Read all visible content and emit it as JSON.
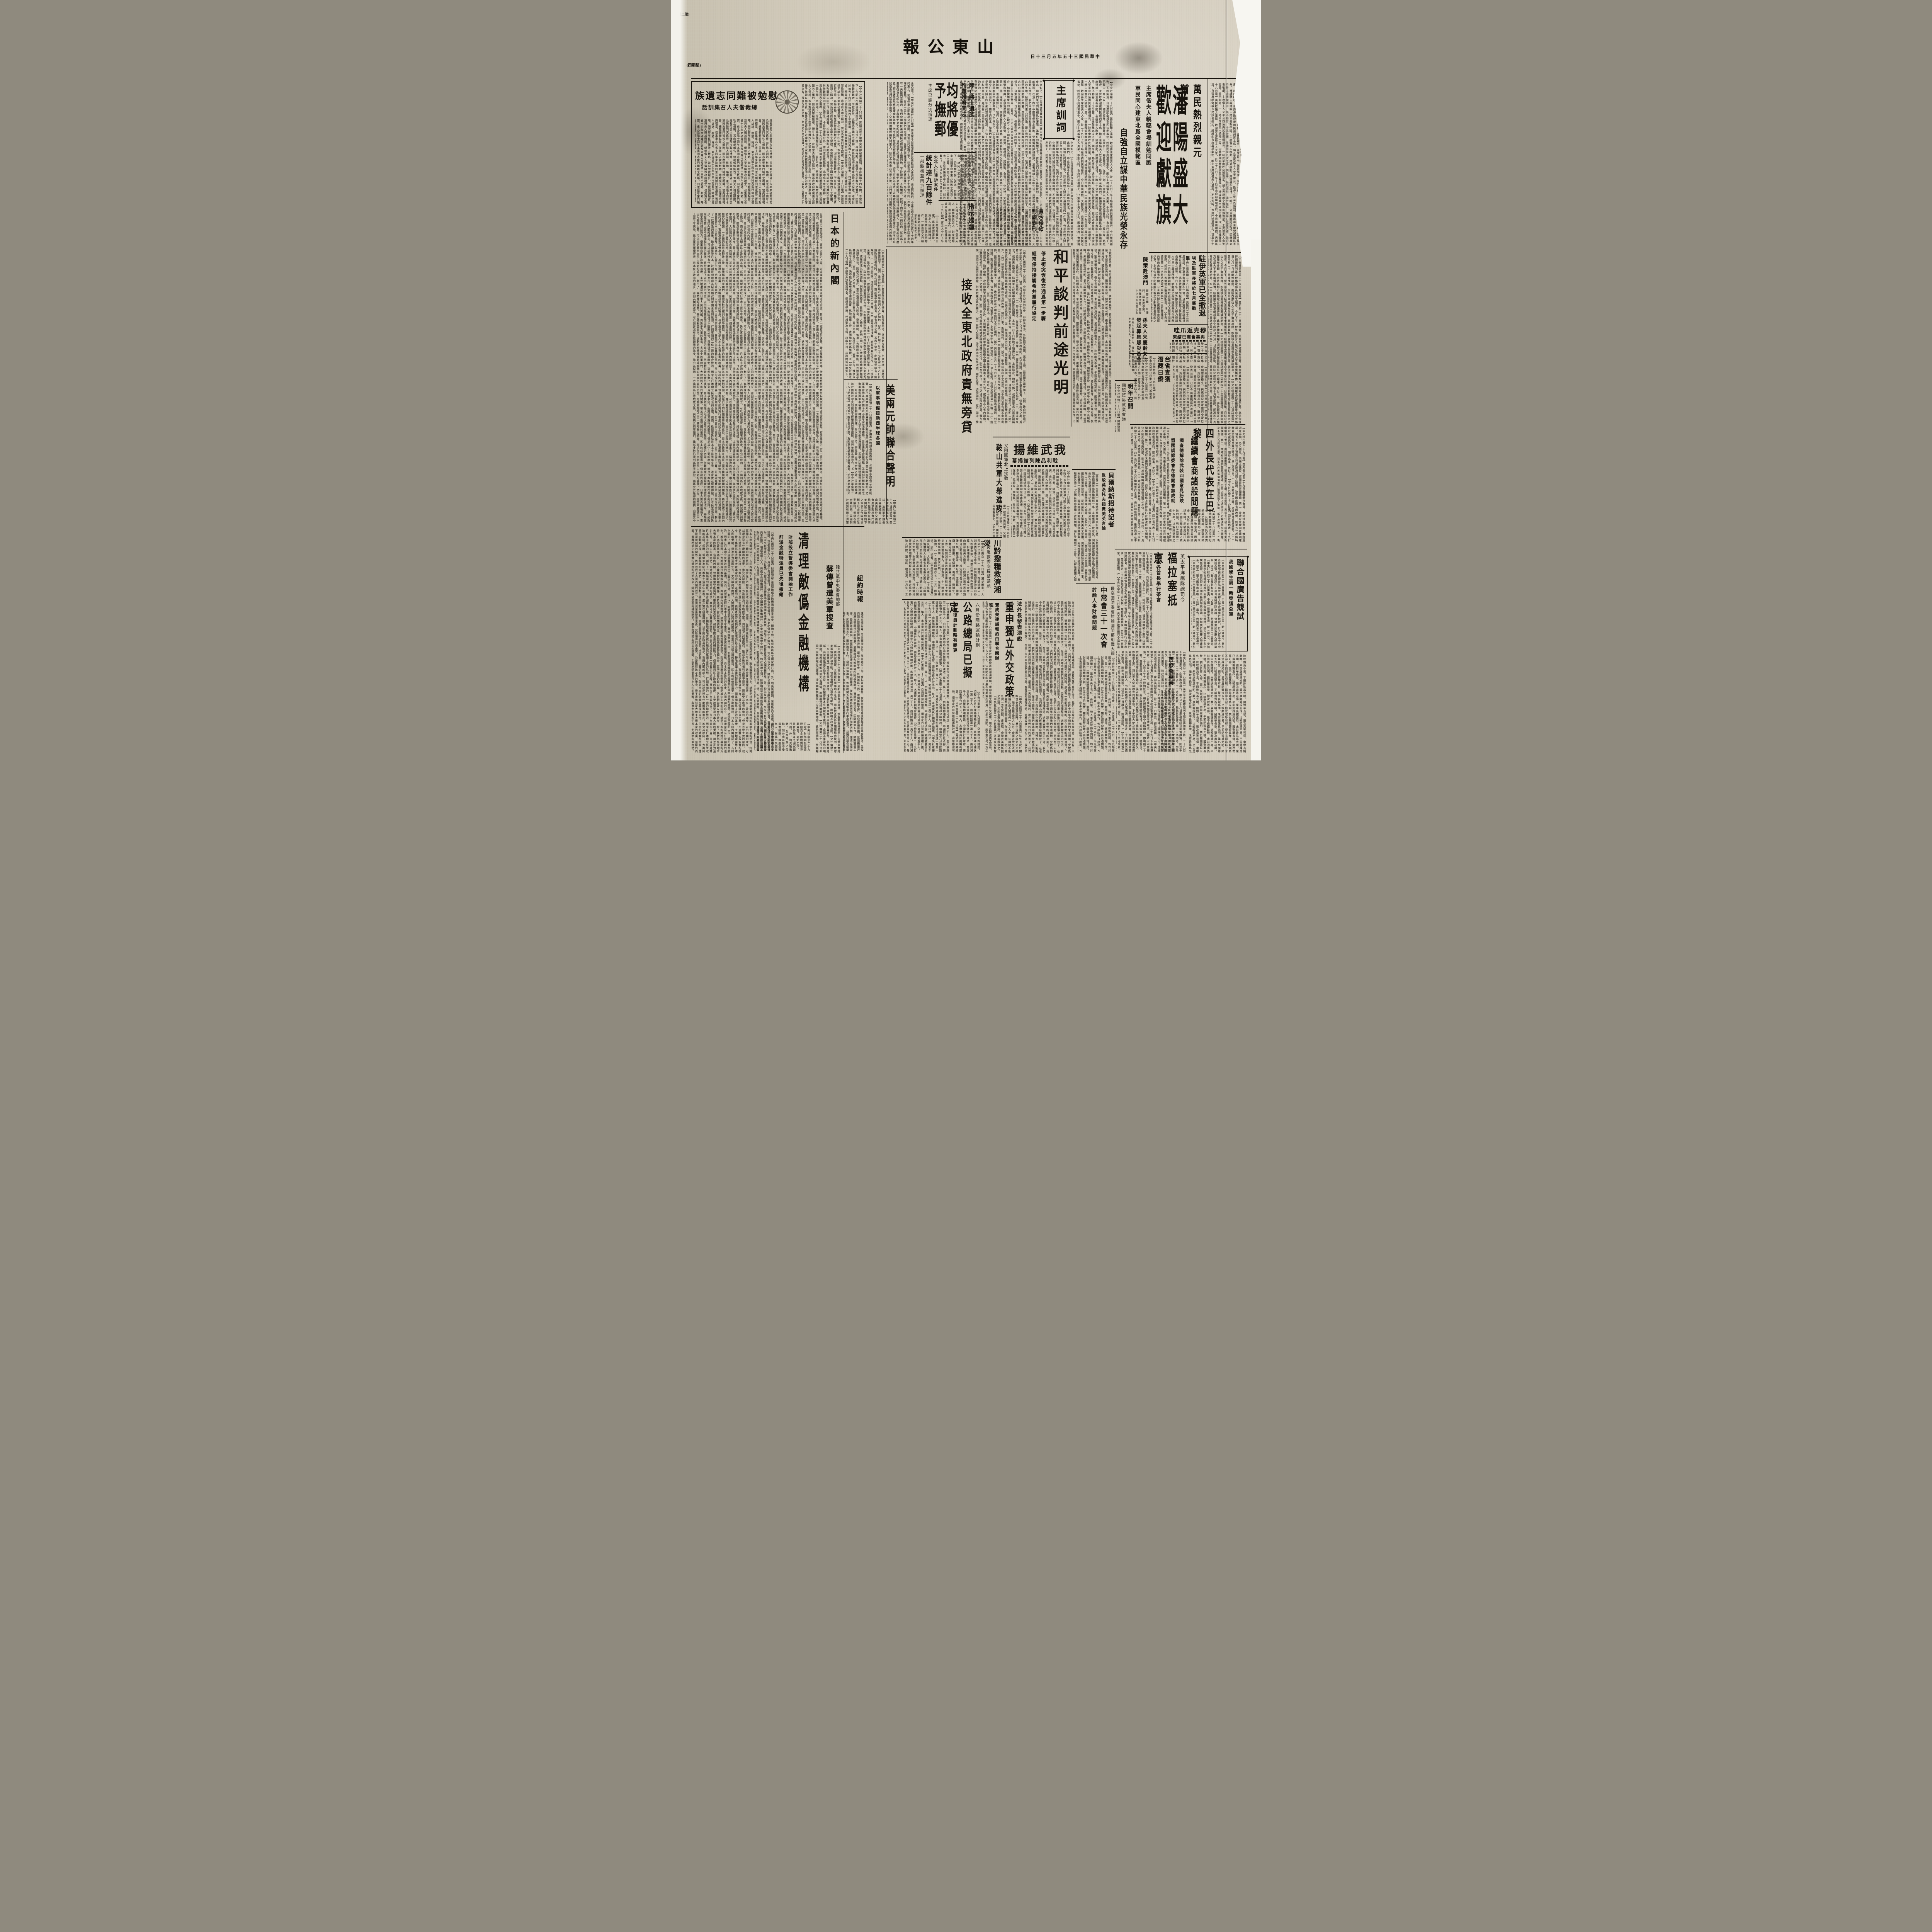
{
  "paper_color": "#cfc8b7",
  "ink_color": "#17130d",
  "icons": {
    "diamond": "◆"
  },
  "header": {
    "page_note": "(第二頁)",
    "weekday": "(星期四)",
    "masthead": "山東公報",
    "dateline": "中華民國三十五年五月三十日"
  },
  "articles": {
    "shenyang": {
      "kicker": "萬民熱烈親元首",
      "title": "瀋陽盛大歡迎獻旗",
      "sub1": "主席偕夫人親臨會場訓勉同胞",
      "sub2": "軍民同心建東北爲全國模範區",
      "bold": "自強自立謀中華民族光榮永存",
      "body": "【中央社瀋陽二十九日電】萬民歡騰之瀋陽、歡迎蔣主席暨夫人大會、於二十九日上午十時在市府前廣場舉行、今日薰風和煦、天朗氣清、自清晨起全城市民扶老攜幼、紛紛向市府廣場集中、瞻仰主席威儀夫人風采、不到九時、市府門前廣場上、已集中十萬人以上、國旗招展、會樂聲喧、主席台上、佈置簡潔、九時三刻、主席偕夫人乘車蒞臨會場、三十萬民衆、熱烈歡呼、並齊呼歡迎復興民族的蔣主席、時正主席偕夫人登主席台、歡呼之聲益爲熱烈、擁護蔣主席完成國民革命、擁護蔣主席建設三民主義新中國、主席暨夫人臨此、民衆感動、頻頻舉手爲禮、十時二十分主席開始訓話、民衆肅立恭聆主席懇摯訓示、無不動容、十五分鐘、民衆鼓掌九次之多、訓話畢、熱烈情形、達於極點、旋舉行獻旗典禮、歡迎大會敬獻、主席偕夫人至平台四角與民衆揚帽相見、一時民衆歡呼民族救星、婦女界所獻之旗爲民族救星、主席暨夫人含笑接受、並示謝意、十一時主席暨夫人繞場一周、中華救國協會獻旗爲世界偉人、禮成後乘車返回行轅、W"
    },
    "xunci": {
      "box_title": "主席訓詞",
      "body": "全文如下、【中央社瀋陽廿九日電】蔣主席今日在瀋各界民衆歡迎大會訓詞、東北同胞們、中正夫婦今日來到淪陷了十四年的東北、和我們東北同胞相見於瀋陽、滿地紅的旗幟之下、這是我們夫婦平生最愉快的一件事、也是我們夫婦十四年來的理想的實現、在這十四年中間我們東北同胞、受敵僞的摧殘壓迫、過著奴隸牛馬的生活、我們中央政府和全國同胞、是沒有一天能夠忘懷的、我們中國國民黨和國民政府領導全國同胞、不辭艱苦、不惜犧牲、抗戰十四年唯一的目的、就是爲了要收復東北的失地、拯救我們東北的同胞、現在我們的目的達到了、我們東北同胞已經獲得自由解放了、我們對於這種歷史上的偉績固然應該慶幸和興奮、然而我們在歡欣鼓舞的時候、切不可忘記過去十四年被異族侵凌奴辱的痛苦、切不可忘記過去我們爲求自由獨立全國同胞犧牲損失的重大、所以今天東北光復之後、我們東北同胞對外要記取過去痛苦的敎訓、鑒傷覆轍、埋頭努力、自重自惜、自立自強、保衛我們自由的領土、促進我們自由的幸福、益使我們中華民族世世代代的子孫能夠自由獨立光榮的生存於世界、（歡呼）中正夫婦此次來到東北主要的目的、是慰問我們歷年來備受痛苦的東北同胞、同時並揭示地方政府、如何復興東北的途徑、（歡呼）今天和各位同胞見面的時候還有幾點簡單的意思、要貢獻給大家、我們今後要求得東北的繁榮和復興、必須我們同胞人人習勤勞、尙勤勞、明禮義、知廉恥、負責任、守紀律、大家在政府的領導之下、軍民一致、同心一德、埋頭苦幹、來建設我們的東北、如此我相信不久的將來、我們東北一定可以成爲全國的模範區、成爲三民主義的實驗地、也必須如此、我們才能安慰十四年來爲收復東北而犧牲的軍民先烈在天之靈、最後中正夫婦以最愉快的心情、謹祝東北同胞自由解放萬歲、V"
    },
    "weimian": {
      "title": "慰勉被難同志遺族",
      "sub": "總裁偕夫人召集訓話",
      "body": "【中央社瀋陽二十九日電】蔣總裁近手諭中央黨部秘書處稱、東北淪陷十四年間、本黨地下工作同志在敵僞摧殘壓迫之下、百折不撓、再接再勵、與敵僞作長期艱苦之奮鬥、因而殉難破難者、所在多有、此種忠勇義烈之精神、實爲我政府收復東北最大之保證、本黨對於過去十四年間殉難烈士之家屬、及殉難同志因工作而致殘廢者、均宜優予撫卹以勵忠貞、秘書處已遵諭訂定殉難同志家屬與被難殘廢同志登記辦法、今日於瀋陽公佈、諸同志冒險犯難、此功成不居之精神、實足爲本黨同志之楷模、",
      "body2": "總裁偕夫人至瀋陽市政府禮堂、召集東北各省十四年來破難同志及殉難同志遺族二百餘人訓話、慰勉、略謂、東北淪陷十四年本黨同志奮鬥犧牲之槪略、同志歷年奮鬥犧牲之槪略、當向總裁報告、總裁頻頻點首、並與夫人親加慰問、"
    },
    "junjiang": {
      "kicker1": "陣亡將士遺族",
      "kicker2": "殉難殘廢同志",
      "title": "均將優予撫郵",
      "sub": "主席已諭分別辦理",
      "body": "【中央社瀋陽廿九日電】蔣主席關懷抗戰陣亡將士遺族、爲同志備受敵僞之迫害、中央無時不在關懷、然當時限於環境、無法援救、諸同志於此種艱難之狀況下、仍能奮鬥努力邁進、廿餘年來我國革命軍東北殉難之先烈在天之靈、東北可成爲全國之模範也、各位愛護過去之精神、刻苦奮鬥、則以今後工作環境之順利、相信各位工作成績亦必更佳於過去、總之今後東北之復興、端賴本黨同志一心同德、協助政府埋頭苦幹、至殉難同志遺族前慰問、接述函件、允予分別從優撫卹云、V"
    },
    "zhishi": {
      "title": "指示婦運",
      "body": "【中央社瀋陽二十九日電】蔣夫人今日下午接見杜夫人、將夫人接見杜夫人、及長官夫人、趙參謀長夫人、對東北婦運、指示各項工作、並詢東北婦運近況甚詳、"
    },
    "tongji": {
      "kicker": "東北人民陳訴案件",
      "title": "統計達九百餘件",
      "sub": "一部將攜至南京辦理",
      "body": "【中央社瀋陽廿九日電】蔣主席蒞瀋後、東北人民紛紛陳訴、其案件統計達九百餘件、一部份已交行轅秘書處分別辦理、一部將攜至南京辦理、"
    },
    "tanwu": {
      "t1": "貪污侵佔",
      "t2": "判處徒刑",
      "body": "（中央社訊）貪污侵佔公款者、經法院判處徒刑、以肅官箴、"
    },
    "heping": {
      "title": "和平談判前途光明",
      "sub1": "停止衝突恢復交通爲第一步驟",
      "sub2": "經常保持接觸希共黨履行協定",
      "side": "接收全東北政府責無旁貸",
      "body": "【中央社南京二十九日電】中部宣外記者招待會、彭部長學沛、外部劉次長鍇、出席主持、茲將問答誌要如下、（問）政府對於最近和平談判之方針如何、（答）與日報五月二十七日及二十八日社論所指出者相同、判之討論、對於若干基本事實、似有忽視之處、爲若干協定、此類協定中有三點規定、（一）停止衝突、恢復交通爲第一步驟、（二）經常保持接觸、希共黨履行協定、（三）接收全東北、政府責無旁貸、綜國軍及統編中共部隊爲國軍、本年一月十日停戰令頒佈以來、上述協定、均經公佈、政府除要求共黨實踐諾言外、不影響國民政府軍隊爲恢復中國主權而進入東北九省、或在東北九省內調動、別無其他條件、目前和平之條件、是明（問）美方代表將時時處於極端爲難之地位、則美方代表少、第三如僅須兩方同意、發布新聞、如須三方面同意始能、則其數量必甚爲稀少、（問）目前之間題、決不因此而有所改變、關於此事、近情如何、（答）如次、惟余以爲和平之前途、決不能以盧布或美金而出賣、馬帥返華之時、述諸階段更爲樂觀、W"
    },
    "riben": {
      "title": "日本的新內閣",
      "body": "日本吉田內閣組成了、吉田內閣的上臺、可以說是替日本民主政治的前途、劃出了一幅黯澹的遠景。聯合國擊毀日本、計劃是想根除其窮兵黷武的軍國主義的思想、打倒軍閥的二位一體的聯合統治、而求在日本樹立民主政治的基礎。然而、從盟軍進駐日本本土這半年來看、進步實在緩慢得很、日本民主政治的進步、吉田內閣的成立、可以說是沒有什麼顯著的進步。推究其原因：一方面因爲日本戰敗之後、與我稱兵的軍閥們、雖然多數已被列爲戰爭罪犯、而將受其應得的懲罰；但是其中主要的原因、就是日本的財閥在幕後的支持、日本的政黨在本質上還不能擺脫財閥的關係、終於造成了吉田內閣的成立、吉田茂是舊官僚出身、其所領導的自由黨、乃是戰前政友會的後身、骨子裏依然是大地主大資本家的政黨、這樣的內閣、很難希望它能夠實行徹底的民主改革、掃除軍國主義的殘餘勢力、倒軍閥與民主政治的演變、主要地還要靠日本人民的覺醒、與進步力量的生長、尤其中的軍閥們、大財閥的人民向來的關係、甚至可以說其鐵的懲罰、民主的成份還需要一個長期的過程、"
    },
    "meiliang": {
      "title": "美兩元帥聯合聲明",
      "sub": "以軍事裝備援助西半球各國",
      "body": "【中央社華盛頓二十八日路透電】美海軍作戰部長尼米茲、及陸軍參謀長艾森豪威爾、於出席美衆院外交委員會要求對杜魯門總統所提關於在與南美國家互助條約下之軍事合作區域計劃予以必要之立法手續時、曾發表聯合聲明稱、美國刻計劃將有限之海軍艦隻與軍事裝備、轉讓予西半球其他美洲國家、美國之防禦體制得與美國經濟劃一、尼米茲稱、該計劃需要訓練、另次戰爭時、得收最大限度合作之效、艾帥則簡述該計劃將以球其他國家之陸軍與空軍體制、得與美國互相符合、W"
    },
    "niuyue": {
      "title": "紐約時報",
      "body": "還成立振災會、民間籌振五作、限開籌振工作、發起普遍募捐、敦請梅蘭芳馬連良等舉行平劇義演、並擬商請各娛樂場所附加救濟捐、"
    },
    "suchuan": {
      "kicker": "韓共黨中央委會總部",
      "title": "蘇傳曾遭美軍搜查",
      "body": "【央社倫敦二十八日合衆電】莫斯科電台頃廣播、搜査朝鮮共產黨中央委員會總部、此共黨總部、共黨報紙案卷均予收沒、而自搜査後各有關報紙未復刊、僉認美軍當局此項舉動、冒在使朝鮮共黨失去威信、而阻礙其政治活動、"
    },
    "qingli": {
      "title": "清理敵僞金融機構",
      "sub1": "財部設立督導委會開始工作",
      "sub2": "前派金融特派員已先後撤銷",
      "body": "【中央社南京二十九日電】財部頃設立清理敵僞金融機搆督導委員會、開始工作、監督各該區之國家銀行局、外、均先後撤銷、至原所負之任務、則分由各督導委員會接辦、理處長等九人、與僞中央儲備銀行、僞中國聯合準備銀行、及東北僞滿中央銀行等、均在清理之列、財部頃設立清理敵僞金融機搆監督、督導各該區之國家銀行局、"
    },
    "wuwu": {
      "title": "我武維揚",
      "sub": "戰利品陳列館揭幕",
      "body": "【中央社南京二十九日電】中國陸軍總部今日上午十時在五台山隆重舉行陣亡將士殉難同胞神位奉移典禮、何總司令應欽、主持奉移典禮、及戰利品陳列館揭幕儀式、到蕭毅肅參謀長、馬超俊、李惟果、周至柔、繆斌、孫桐崗二百餘人、首由何氏致詞、由何氏之女公子爲陳列館內致綵揭旋、全體人員隨即入舘參觀一週、第一陳列室分爲受降紀念室及戰史資料室二部、第二陳列室爲兵器、空軍器材部、通訊器材部、第三陳列室爲工兵器材及粮秣被服四部、第四陳列室爲衛生部之一、第五陳列室爲兵器部之二、露天陳列者尙有飛機大砲橡皮艇浮橋器材部、日本文獻部、V"
    },
    "anshan": {
      "kicker": "又阻國軍北上接收",
      "title": "鞍山共軍大舉進攻",
      "body": "【中央社瀋陽二十九日電】鞍山方面共軍、又阻國軍北上接收、二十八日拂曉起大舉進攻、國軍正沉着應戰中、"
    },
    "chuanqian": {
      "kicker": "湘災急救委向糧部請願",
      "title": "川黔撥糧救濟湘災",
      "body": "【中央社南京二十九日電】湘災嚴重、人民死亡已達三百二十餘萬、在滬湘籍人士湘省委毛秉文來京、幷與糧部接洽及向各方呼籲急賑、頃悉川黔兩省各撥糧二十萬、担運湘救濟、二十八日開成立大會、由湘參議員方鼎英、行總湘分署代表章翔等分別報告災情、推定滬市各流孔祥熙、潘公展、程滄波、杜月笙、王曉籟、徐寄廎、顏惠慶、吳紹澍、馮有眞、劉鴻生、梅蘭芳等二十五人爲委員、積極展開籌振工作、時間湘災急救委員會專科以上學校災賑濟聯合會人、請求救濟、十一時半至粮食部請願、要求六項、（一）應在六月運濟湘、（二）去歲田粮存谷、（三）即運湘、（四）湘省、"
    },
    "gonglu": {
      "kicker": "六月份陸路運輸計劃",
      "title": "公路總局已擬定",
      "sub": "水運復員計劃略有變更",
      "body": "【中央社重慶二十九日電】交通部公路總局、頃擬定六月份陸路運輸計劃、客票聯運可運送一萬二千人、由川陝路至一萬五千人、由川湘路及西南路自渝至衡陽段可運送一萬至一萬五千人、由衡陽轉湘桂路、中國旅行社承辦、兩路收費合計五元、每人、水運復員計劃略有變更、"
    },
    "fawai": {
      "kicker": "法外長發表演說",
      "title": "重申獨立外交政策",
      "sub": "贊成美建議和約由聯合國辦理",
      "body": "【中央社巴黎二十八日專電】法外長皮杜爾昨發表競選演說時、重申法國之獨立外交政策、絕不受蘇或美之左右、余謹告欲見法國尾隨此兩大國任何一方之人士、法國絕不能以盧布或美金而出賣、在余任期間、絕不受任何一方之支配、皮氏稱、余贊成美國所提之建議、和約由聯合國辦理、草擬辦理之、"
    },
    "zhongchang": {
      "side": "最高國防委會討論國防部組織大綱",
      "title": "中常會三十一次會",
      "sub": "討論人事財務問題",
      "body": "【中央社南京二十九日電】中常會三十一次會議、二十九日上午九時在國府舉行、出席委員于右任、孫科等、對人事及財務等問題、均有討論、致十二時續開國防最高委員會、兪鴻鈞、徐堪、蔣夢麟亦均出席、討論國防部組織大綱、幷定三十日提會、關於調整公敎人員待遇問題、上星期總裁曾指定擬定具體辦法、向本次會報告、惟行政院今日提出、V"
    },
    "beier": {
      "title": "貝爾納斯招待記者",
      "sub": "反駁莫洛托夫指責美英言論",
      "body": "【美國二十八日電】貝爾納斯國務卿頃招待記者、反駁莫洛托夫指責美英之言論、調查德國解除武備情形一事、未能獲得一致意見、因美國建議解除各項武備調查、夫昨在莫斯科招待記者時、反駁莫洛托夫「企圖以解除德國之武裝問題、强訂立期限二十五年、以解除德國之威脅、在原則上曾同意、」"
    },
    "siwai": {
      "title": "四外長代表在巴黎",
      "sub": "繼續會商諸般問題",
      "sub2": "調査德解除武裝四國意見紛歧",
      "sub3": "盟國調節委會在德開會無成就",
      "body": "【中央社巴黎二十九日電】四外長代表二十九日繼續舉行會議、商討諸般問題、惟經過選在手續、恐又遷延、表張主任發、誤而喪失新聞價値、第二、故政府未便同意此項建議、但吾人深信上述辦法已足解決目前之間題、決不因此而有所改變、則美方代表將時時處於極端爲難之地位、爲上述理由、（一）馬帥返華之時、述諸階段更爲樂觀、（二）政府收復長春時、關於此事、更好之、"
    },
    "zhuyi": {
      "title": "駐伊英軍已全撤退",
      "sub": "埃及駐軍亦將於七月底撤畢",
      "body": "【中央社德黑蘭二十八日路透電】莫斯科二十三日廣播謂、英軍尙未撤離布什爾、且未將其鄰近廣播電台交還伊軍、此係依據伊朗報紙刊載之伊郵電部長來函之報導、今日下午、伊外部發言人極力否認大不里士廣播所傳、駐開羅之英軍總部奉命令所部自六月一日起開始調動、而駐亞歷山大之若干海軍部隊、卽將移往馬爾他及塞浦路斯島、W"
    },
    "muke": {
      "title": "穆克返爪哇",
      "sub": "與英會商已結束",
      "body": "【中央社加新坡二十八日專電】荷駐東印度副總督穆克、與東南亞盟軍總司令蒙巴頓、英駐東南亞特派員基勒恩、商討東印問題、關於商討之主題及結果、勢難未能發表公報、已於今晨乘機返巴達維亞、T"
    },
    "taisheng": {
      "t1": "台省査獲",
      "t2": "潛藏日僑",
      "body": "【中央社台北二十九日電】台省近由台南新北台東及合北等地査獲潛藏之日僑一百零五名、已於目前遣返日本、另五十餘名、將於日內遣送、T"
    },
    "chence": {
      "title": "陳策赴澳門",
      "body": "督黎恩樂、在澳門、羅主席卓英、回拜澳總督、然後赴中山縣訪國父故鄕、返廣州、T"
    },
    "mingnian": {
      "title": "明年召開",
      "sub": "國際貿易就業會議",
      "body": "【中央社紐約二十八日電】國際貿易就業會議、將於明年召開、家小組委員會、四外長代表、"
    },
    "sunfuren": {
      "t1": "孫夫人宋慶齡女士",
      "t2": "發起募集賑災基金",
      "body": "孫夫人宋慶齡女士、發起募集賑災基金、救濟湘粤災民、各界聞風響應者甚衆、"
    },
    "lianheguo": {
      "title": "聯合國廣告競試",
      "sub": "我國學生周一新榮獲亞軍",
      "body": "【中央社紐約二十八日專電】中國一藝術學生周一新（譯音）、參加基督敎學術言報雜誌部所主辦之聯合國廣告競試、於六百五十名中榮獲亞軍、周君現在芝加哥藝術學院攻讀、曾畢業於重慶大學建築系、渠之「聯合國到和平唯一之路」廣告、約獲獎金二十五萬元、"
    },
    "fulasai": {
      "kicker": "英太平洋艦隊總司令",
      "title": "福拉塞抵京",
      "sub": "邀我各首長舉行茶會",
      "body": "【中央社南京二十九日電】英太平洋艦隊總司令福拉塞海軍上將、二十九日下午由港來京、向我政府辭行、福氏二十六日乘旗艦紐芬蘭號離滬、因途中四度擱淺、二十九日上午十一時始抵京、福氏旗艦駛下關中山碼頭時、卽鳴砲二十一響、並懸我國旗、以示敬意、我永綏艦亦鳴砲答禮、並派海軍上尉兪信、代表我國海軍赴旗艦歡迎、英首相私人代表魏亞特繼上艦與福氏暢談良久、卽相偕上岸、拜訪英大使薛穆並同進午餐、下午薛大使及我國海軍副處長周憲章、約赴旗艦拜訪、下午五時福氏在旗艦上舉行鷄尾酒會、到我黨政軍首長及各國使節二百餘人、七時該艦舉行火花表演、聞福氏定三十日謁陵及憑弔宋院長、陳部長誠宴後、於三十一日離京、經港返國、L"
    },
    "xizhao": {
      "title": "西照會英美",
      "body": "能創建和平之大國之手、而將大國間所產之困難陳諸世界、明西班牙有重整軍備、究原子舘之權利、W"
    },
    "fillers": {
      "a": "在這十四年中間我們東北同胞、受敵僞的摧殘壓迫、過着奴隸牛馬的生活、我們中央政府和全國同胞、是沒有一天能夠忘懷的、現在我們的目的達到了、我們東北同胞已經獲得自由解放了、",
      "b": "比較頗爲不易、平前途殊爲光明、國對華長發、劉次君等可得、復中長鐵路時、未前途殊爲光明、業已展開籌振五作、"
    }
  }
}
